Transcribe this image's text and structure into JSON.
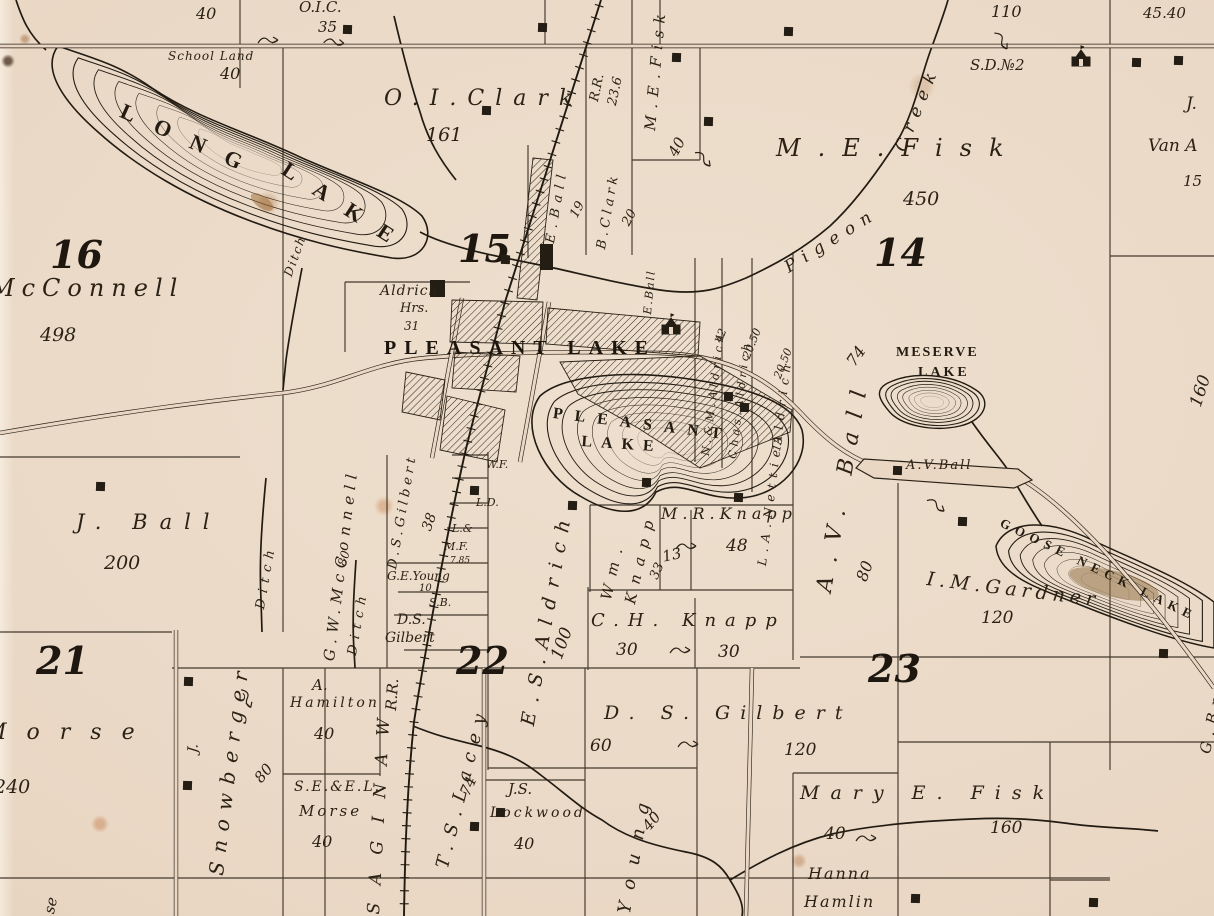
{
  "map": {
    "kind": "antique-township-plat-map",
    "colors": {
      "paper": "#e9d7c4",
      "ink": "#2b2217",
      "lake_stain": "#8a6a3e"
    },
    "labels": [
      {
        "t": "40",
        "x": 196,
        "y": 6,
        "fs": 16,
        "cls": "n"
      },
      {
        "t": "O.I.C.",
        "x": 299,
        "y": 0,
        "fs": 15,
        "cls": "n"
      },
      {
        "t": "35",
        "x": 318,
        "y": 20,
        "fs": 15,
        "cls": "n"
      },
      {
        "t": "School Land",
        "x": 168,
        "y": 50,
        "fs": 12,
        "ls": 1,
        "cls": "n"
      },
      {
        "t": "40",
        "x": 220,
        "y": 66,
        "fs": 16,
        "cls": "n"
      },
      {
        "t": "110",
        "x": 991,
        "y": 4,
        "fs": 16,
        "cls": "n"
      },
      {
        "t": "45.40",
        "x": 1143,
        "y": 6,
        "fs": 15,
        "cls": "n"
      },
      {
        "t": "R.R.",
        "x": 588,
        "y": 100,
        "rot": -78,
        "fs": 13,
        "cls": "n"
      },
      {
        "t": "23.6",
        "x": 606,
        "y": 104,
        "rot": -78,
        "fs": 13,
        "cls": "n"
      },
      {
        "t": "M.E.Fisk",
        "x": 643,
        "y": 130,
        "rot": -85,
        "fs": 15,
        "ls": 7,
        "cls": "n"
      },
      {
        "t": "40",
        "x": 666,
        "y": 152,
        "rot": -62,
        "fs": 15,
        "cls": "n"
      },
      {
        "t": "16",
        "x": 50,
        "y": 236,
        "fs": 38,
        "cls": "s"
      },
      {
        "t": "McConnell",
        "x": -10,
        "y": 276,
        "fs": 24,
        "ls": 7,
        "cls": "n"
      },
      {
        "t": "498",
        "x": 40,
        "y": 326,
        "fs": 19,
        "cls": "n"
      },
      {
        "t": "LONG",
        "x": 126,
        "y": 100,
        "rot": 24,
        "fs": 22,
        "ls": 22,
        "cls": "c"
      },
      {
        "t": "LAKE",
        "x": 290,
        "y": 158,
        "rot": 33,
        "fs": 22,
        "ls": 22,
        "cls": "c"
      },
      {
        "t": "Ditch",
        "x": 282,
        "y": 274,
        "rot": -70,
        "fs": 12,
        "ls": 2,
        "cls": "n"
      },
      {
        "t": "O.I.Clark",
        "x": 384,
        "y": 88,
        "fs": 22,
        "ls": 11,
        "cls": "n"
      },
      {
        "t": "161",
        "x": 426,
        "y": 126,
        "fs": 19,
        "cls": "n"
      },
      {
        "t": "15",
        "x": 458,
        "y": 230,
        "fs": 38,
        "cls": "s"
      },
      {
        "t": "E.Ball",
        "x": 544,
        "y": 242,
        "rot": -80,
        "fs": 13,
        "ls": 6,
        "cls": "n"
      },
      {
        "t": "19",
        "x": 568,
        "y": 214,
        "rot": -62,
        "fs": 13,
        "cls": "n"
      },
      {
        "t": "B.Clark",
        "x": 595,
        "y": 248,
        "rot": -80,
        "fs": 13,
        "ls": 4,
        "cls": "n"
      },
      {
        "t": "20",
        "x": 620,
        "y": 222,
        "rot": -62,
        "fs": 13,
        "cls": "n"
      },
      {
        "t": "E.Ball",
        "x": 642,
        "y": 314,
        "rot": -85,
        "fs": 11,
        "ls": 2,
        "cls": "n"
      },
      {
        "t": "M.E.Fisk",
        "x": 776,
        "y": 136,
        "fs": 24,
        "ls": 17,
        "cls": "n"
      },
      {
        "t": "450",
        "x": 903,
        "y": 190,
        "fs": 19,
        "cls": "n"
      },
      {
        "t": "14",
        "x": 874,
        "y": 234,
        "fs": 38,
        "cls": "s"
      },
      {
        "t": "Pigeon",
        "x": 782,
        "y": 262,
        "rot": -32,
        "fs": 17,
        "ls": 8,
        "cls": "n"
      },
      {
        "t": "Creek",
        "x": 893,
        "y": 148,
        "rot": -68,
        "fs": 17,
        "ls": 8,
        "cls": "n"
      },
      {
        "t": "S.D.№2",
        "x": 970,
        "y": 58,
        "fs": 15,
        "cls": "n"
      },
      {
        "t": "J.",
        "x": 1186,
        "y": 96,
        "fs": 17,
        "cls": "n"
      },
      {
        "t": "Van A",
        "x": 1148,
        "y": 138,
        "fs": 17,
        "cls": "n"
      },
      {
        "t": "15",
        "x": 1183,
        "y": 174,
        "fs": 15,
        "cls": "n"
      },
      {
        "t": "160",
        "x": 1188,
        "y": 404,
        "rot": -72,
        "fs": 17,
        "cls": "n"
      },
      {
        "t": "Aldrich",
        "x": 380,
        "y": 284,
        "fs": 14,
        "ls": 1,
        "cls": "n"
      },
      {
        "t": "Hrs.",
        "x": 400,
        "y": 302,
        "fs": 13,
        "cls": "n"
      },
      {
        "t": "31",
        "x": 404,
        "y": 320,
        "fs": 12,
        "cls": "n"
      },
      {
        "t": "PLEASANT LAKE",
        "x": 384,
        "y": 338,
        "fs": 20,
        "ls": 8,
        "cls": "v"
      },
      {
        "t": "PLEASANT",
        "x": 554,
        "y": 406,
        "rot": 7,
        "fs": 16,
        "ls": 12,
        "cls": "c"
      },
      {
        "t": "LAKE",
        "x": 582,
        "y": 434,
        "rot": 4,
        "fs": 16,
        "ls": 9,
        "cls": "c"
      },
      {
        "t": "N.&M.Aldrich",
        "x": 700,
        "y": 455,
        "rot": -83,
        "fs": 11,
        "ls": 4,
        "cls": "n"
      },
      {
        "t": "42",
        "x": 713,
        "y": 340,
        "rot": -68,
        "fs": 11,
        "cls": "n"
      },
      {
        "t": "Chas.Aldrich",
        "x": 727,
        "y": 458,
        "rot": -83,
        "fs": 11,
        "ls": 4,
        "cls": "n"
      },
      {
        "t": "20.50",
        "x": 741,
        "y": 356,
        "rot": -68,
        "fs": 11,
        "cls": "n"
      },
      {
        "t": "L.A.NettieAldrich",
        "x": 756,
        "y": 565,
        "rot": -83,
        "fs": 12,
        "ls": 6,
        "cls": "n"
      },
      {
        "t": "20.50",
        "x": 772,
        "y": 376,
        "rot": -68,
        "fs": 11,
        "cls": "n"
      },
      {
        "t": "13",
        "x": 771,
        "y": 450,
        "rot": -78,
        "fs": 11,
        "cls": "n"
      },
      {
        "t": "74",
        "x": 844,
        "y": 360,
        "rot": -55,
        "fs": 16,
        "cls": "n"
      },
      {
        "t": "A.V. Ball",
        "x": 814,
        "y": 590,
        "rot": -80,
        "fs": 22,
        "ls": 14,
        "cls": "n"
      },
      {
        "t": "80",
        "x": 854,
        "y": 578,
        "rot": -70,
        "fs": 16,
        "cls": "n"
      },
      {
        "t": "MESERVE",
        "x": 896,
        "y": 346,
        "fs": 14,
        "ls": 2,
        "cls": "c"
      },
      {
        "t": "LAKE",
        "x": 918,
        "y": 366,
        "fs": 14,
        "ls": 3,
        "cls": "c"
      },
      {
        "t": "A.V.Ball",
        "x": 906,
        "y": 459,
        "fs": 13,
        "ls": 2,
        "cls": "n"
      },
      {
        "t": "GOOSE NECK LAKE",
        "x": 1004,
        "y": 516,
        "rot": 26,
        "fs": 13,
        "ls": 6,
        "cls": "c"
      },
      {
        "t": "I.M.Gardner",
        "x": 928,
        "y": 570,
        "rot": 7,
        "fs": 19,
        "ls": 5,
        "cls": "n"
      },
      {
        "t": "120",
        "x": 981,
        "y": 610,
        "fs": 17,
        "cls": "n"
      },
      {
        "t": "G.Brooks",
        "x": 1198,
        "y": 752,
        "rot": -78,
        "fs": 15,
        "ls": 7,
        "cls": "n"
      },
      {
        "t": "Wm.",
        "x": 599,
        "y": 598,
        "rot": -77,
        "fs": 15,
        "ls": 9,
        "cls": "n"
      },
      {
        "t": "Knapp",
        "x": 623,
        "y": 602,
        "rot": -77,
        "fs": 15,
        "ls": 9,
        "cls": "n"
      },
      {
        "t": "33",
        "x": 648,
        "y": 576,
        "rot": -66,
        "fs": 13,
        "cls": "n"
      },
      {
        "t": "M.R.Knapp",
        "x": 661,
        "y": 506,
        "fs": 16,
        "ls": 5,
        "cls": "n"
      },
      {
        "t": "48",
        "x": 726,
        "y": 538,
        "fs": 17,
        "cls": "n"
      },
      {
        "t": "13",
        "x": 661,
        "y": 550,
        "rot": -12,
        "fs": 15,
        "cls": "n"
      },
      {
        "t": "C.H. Knapp",
        "x": 591,
        "y": 612,
        "fs": 18,
        "ls": 9,
        "cls": "n"
      },
      {
        "t": "30",
        "x": 616,
        "y": 642,
        "fs": 17,
        "cls": "n"
      },
      {
        "t": "30",
        "x": 718,
        "y": 644,
        "fs": 17,
        "cls": "n"
      },
      {
        "t": "E.S.Aldrich",
        "x": 519,
        "y": 724,
        "rot": -80,
        "fs": 19,
        "ls": 10,
        "cls": "n"
      },
      {
        "t": "100",
        "x": 549,
        "y": 656,
        "rot": -70,
        "fs": 17,
        "cls": "n"
      },
      {
        "t": "22",
        "x": 456,
        "y": 642,
        "fs": 38,
        "cls": "s"
      },
      {
        "t": "J. Ball",
        "x": 76,
        "y": 512,
        "fs": 21,
        "ls": 12,
        "cls": "n"
      },
      {
        "t": "200",
        "x": 104,
        "y": 554,
        "fs": 19,
        "cls": "n"
      },
      {
        "t": "Ditch",
        "x": 254,
        "y": 608,
        "rot": -80,
        "fs": 13,
        "ls": 6,
        "cls": "n"
      },
      {
        "t": "Ditch",
        "x": 346,
        "y": 654,
        "rot": -80,
        "fs": 13,
        "ls": 6,
        "cls": "n"
      },
      {
        "t": "G.W.McConnell",
        "x": 322,
        "y": 660,
        "rot": -83,
        "fs": 15,
        "ls": 6,
        "cls": "n"
      },
      {
        "t": "80",
        "x": 336,
        "y": 564,
        "rot": -74,
        "fs": 12,
        "cls": "n"
      },
      {
        "t": "D.S.Gilbert",
        "x": 386,
        "y": 568,
        "rot": -80,
        "fs": 13,
        "ls": 4,
        "cls": "n"
      },
      {
        "t": "38",
        "x": 420,
        "y": 528,
        "rot": -70,
        "fs": 14,
        "cls": "n"
      },
      {
        "t": "W.F.",
        "x": 486,
        "y": 459,
        "fs": 11,
        "cls": "n"
      },
      {
        "t": "L.D.",
        "x": 476,
        "y": 497,
        "fs": 11,
        "cls": "n"
      },
      {
        "t": "L.&",
        "x": 452,
        "y": 523,
        "fs": 11,
        "cls": "n"
      },
      {
        "t": "M.F.",
        "x": 444,
        "y": 541,
        "fs": 11,
        "cls": "n"
      },
      {
        "t": "7.85",
        "x": 450,
        "y": 557,
        "fs": 9,
        "cls": "n"
      },
      {
        "t": "G.E.Young",
        "x": 387,
        "y": 570,
        "fs": 12,
        "cls": "n"
      },
      {
        "t": "10",
        "x": 419,
        "y": 584,
        "fs": 10,
        "cls": "n"
      },
      {
        "t": "S.B.",
        "x": 429,
        "y": 597,
        "fs": 11,
        "cls": "n"
      },
      {
        "t": "D.S.",
        "x": 397,
        "y": 613,
        "fs": 14,
        "cls": "n"
      },
      {
        "t": "Gilbert",
        "x": 385,
        "y": 631,
        "fs": 14,
        "cls": "n"
      },
      {
        "t": "R.R.",
        "x": 384,
        "y": 710,
        "rot": -86,
        "fs": 15,
        "cls": "n"
      },
      {
        "t": "SAGINAW",
        "x": 366,
        "y": 914,
        "rot": -87,
        "fs": 17,
        "ls": 18,
        "cls": "n"
      },
      {
        "t": "T.S.Lacey",
        "x": 434,
        "y": 866,
        "rot": -76,
        "fs": 18,
        "ls": 9,
        "cls": "n"
      },
      {
        "t": "74",
        "x": 458,
        "y": 792,
        "rot": -66,
        "fs": 15,
        "cls": "n"
      },
      {
        "t": "21",
        "x": 36,
        "y": 642,
        "fs": 38,
        "cls": "s"
      },
      {
        "t": "Morse",
        "x": -16,
        "y": 722,
        "fs": 22,
        "ls": 20,
        "cls": "n"
      },
      {
        "t": "240",
        "x": -6,
        "y": 778,
        "fs": 19,
        "cls": "n"
      },
      {
        "t": "J.",
        "x": 186,
        "y": 752,
        "rot": -84,
        "fs": 14,
        "cls": "n"
      },
      {
        "t": "Snowberger",
        "x": 206,
        "y": 874,
        "rot": -83,
        "fs": 20,
        "ls": 9,
        "cls": "n"
      },
      {
        "t": "80",
        "x": 252,
        "y": 776,
        "rot": -50,
        "fs": 15,
        "cls": "n"
      },
      {
        "t": "A.",
        "x": 312,
        "y": 678,
        "fs": 15,
        "cls": "n"
      },
      {
        "t": "Hamilton",
        "x": 290,
        "y": 696,
        "fs": 14,
        "ls": 3,
        "cls": "n"
      },
      {
        "t": "40",
        "x": 314,
        "y": 726,
        "fs": 16,
        "cls": "n"
      },
      {
        "t": "S.E.&E.L.",
        "x": 294,
        "y": 780,
        "fs": 14,
        "ls": 2,
        "cls": "n"
      },
      {
        "t": "Morse",
        "x": 299,
        "y": 804,
        "fs": 15,
        "ls": 3,
        "cls": "n"
      },
      {
        "t": "40",
        "x": 312,
        "y": 834,
        "fs": 16,
        "cls": "n"
      },
      {
        "t": "J.S.",
        "x": 508,
        "y": 782,
        "fs": 15,
        "cls": "n"
      },
      {
        "t": "Lockwood",
        "x": 490,
        "y": 806,
        "fs": 14,
        "ls": 3,
        "cls": "n"
      },
      {
        "t": "40",
        "x": 514,
        "y": 836,
        "fs": 16,
        "cls": "n"
      },
      {
        "t": "Young",
        "x": 616,
        "y": 912,
        "rot": -80,
        "fs": 18,
        "ls": 14,
        "cls": "n"
      },
      {
        "t": "40",
        "x": 640,
        "y": 824,
        "rot": -50,
        "fs": 15,
        "cls": "n"
      },
      {
        "t": "D. S. Gilbert",
        "x": 604,
        "y": 704,
        "fs": 19,
        "ls": 10,
        "cls": "n"
      },
      {
        "t": "60",
        "x": 590,
        "y": 738,
        "fs": 17,
        "cls": "n"
      },
      {
        "t": "120",
        "x": 784,
        "y": 742,
        "fs": 17,
        "cls": "n"
      },
      {
        "t": "23",
        "x": 868,
        "y": 650,
        "fs": 38,
        "cls": "s"
      },
      {
        "t": "Mary E. Fisk",
        "x": 800,
        "y": 784,
        "fs": 19,
        "ls": 11,
        "cls": "n"
      },
      {
        "t": "40",
        "x": 824,
        "y": 826,
        "fs": 17,
        "cls": "n"
      },
      {
        "t": "160",
        "x": 990,
        "y": 820,
        "fs": 17,
        "cls": "n"
      },
      {
        "t": "Hanna",
        "x": 808,
        "y": 866,
        "fs": 16,
        "ls": 2,
        "cls": "n"
      },
      {
        "t": "Hamlin",
        "x": 804,
        "y": 894,
        "fs": 16,
        "ls": 2,
        "cls": "n"
      },
      {
        "t": "se",
        "x": 42,
        "y": 912,
        "rot": -78,
        "fs": 15,
        "cls": "n"
      }
    ],
    "house_symbols": [
      [
        347,
        29
      ],
      [
        542,
        27
      ],
      [
        676,
        57
      ],
      [
        708,
        121
      ],
      [
        788,
        31
      ],
      [
        1136,
        62
      ],
      [
        1178,
        60
      ],
      [
        486,
        110
      ],
      [
        505,
        259
      ],
      [
        728,
        396
      ],
      [
        744,
        407
      ],
      [
        646,
        482
      ],
      [
        572,
        505
      ],
      [
        738,
        497
      ],
      [
        474,
        490
      ],
      [
        962,
        521
      ],
      [
        1163,
        653
      ],
      [
        188,
        681
      ],
      [
        187,
        785
      ],
      [
        100,
        486
      ],
      [
        500,
        812
      ],
      [
        474,
        826
      ],
      [
        915,
        898
      ],
      [
        1093,
        902
      ],
      [
        897,
        470
      ]
    ],
    "school_symbols": [
      [
        1072,
        50
      ],
      [
        662,
        318
      ]
    ],
    "survey_marks": [
      [
        270,
        40,
        0
      ],
      [
        336,
        42,
        10
      ],
      [
        1003,
        42,
        60
      ],
      [
        705,
        160,
        50
      ],
      [
        688,
        546,
        0
      ],
      [
        682,
        650,
        0
      ],
      [
        690,
        744,
        0
      ],
      [
        868,
        838,
        0
      ],
      [
        938,
        506,
        40
      ],
      [
        248,
        700,
        70
      ]
    ]
  }
}
